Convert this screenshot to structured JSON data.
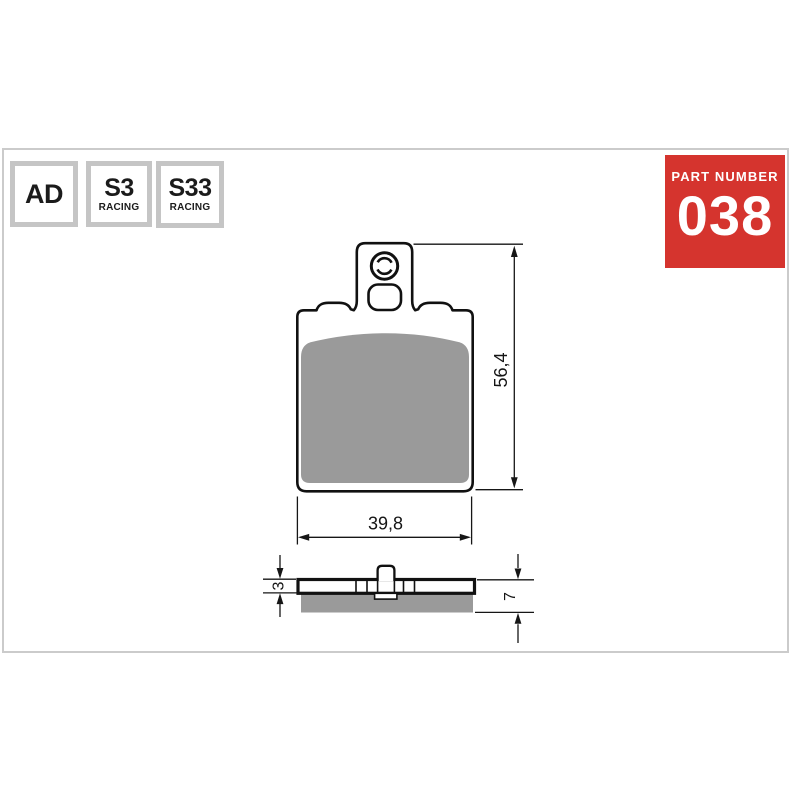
{
  "frame": {
    "border_color": "#cbcbcb"
  },
  "badges": [
    {
      "id": "ad",
      "line1": "AD",
      "line2": ""
    },
    {
      "id": "s3",
      "line1": "S3",
      "line2": "RACING"
    },
    {
      "id": "s33",
      "line1": "S33",
      "line2": "RACING"
    }
  ],
  "part_box": {
    "label": "PART NUMBER",
    "number": "038",
    "bg_color": "#d5342e",
    "text_color": "#ffffff"
  },
  "drawing": {
    "type": "brake-pad-technical-drawing",
    "views": {
      "front": {
        "height_dim": "56,4",
        "width_dim": "39,8"
      },
      "side": {
        "backplate_thickness_dim": "3",
        "total_thickness_dim": "7"
      }
    },
    "colors": {
      "outline": "#111111",
      "friction_material": "#9a9a9a"
    }
  }
}
